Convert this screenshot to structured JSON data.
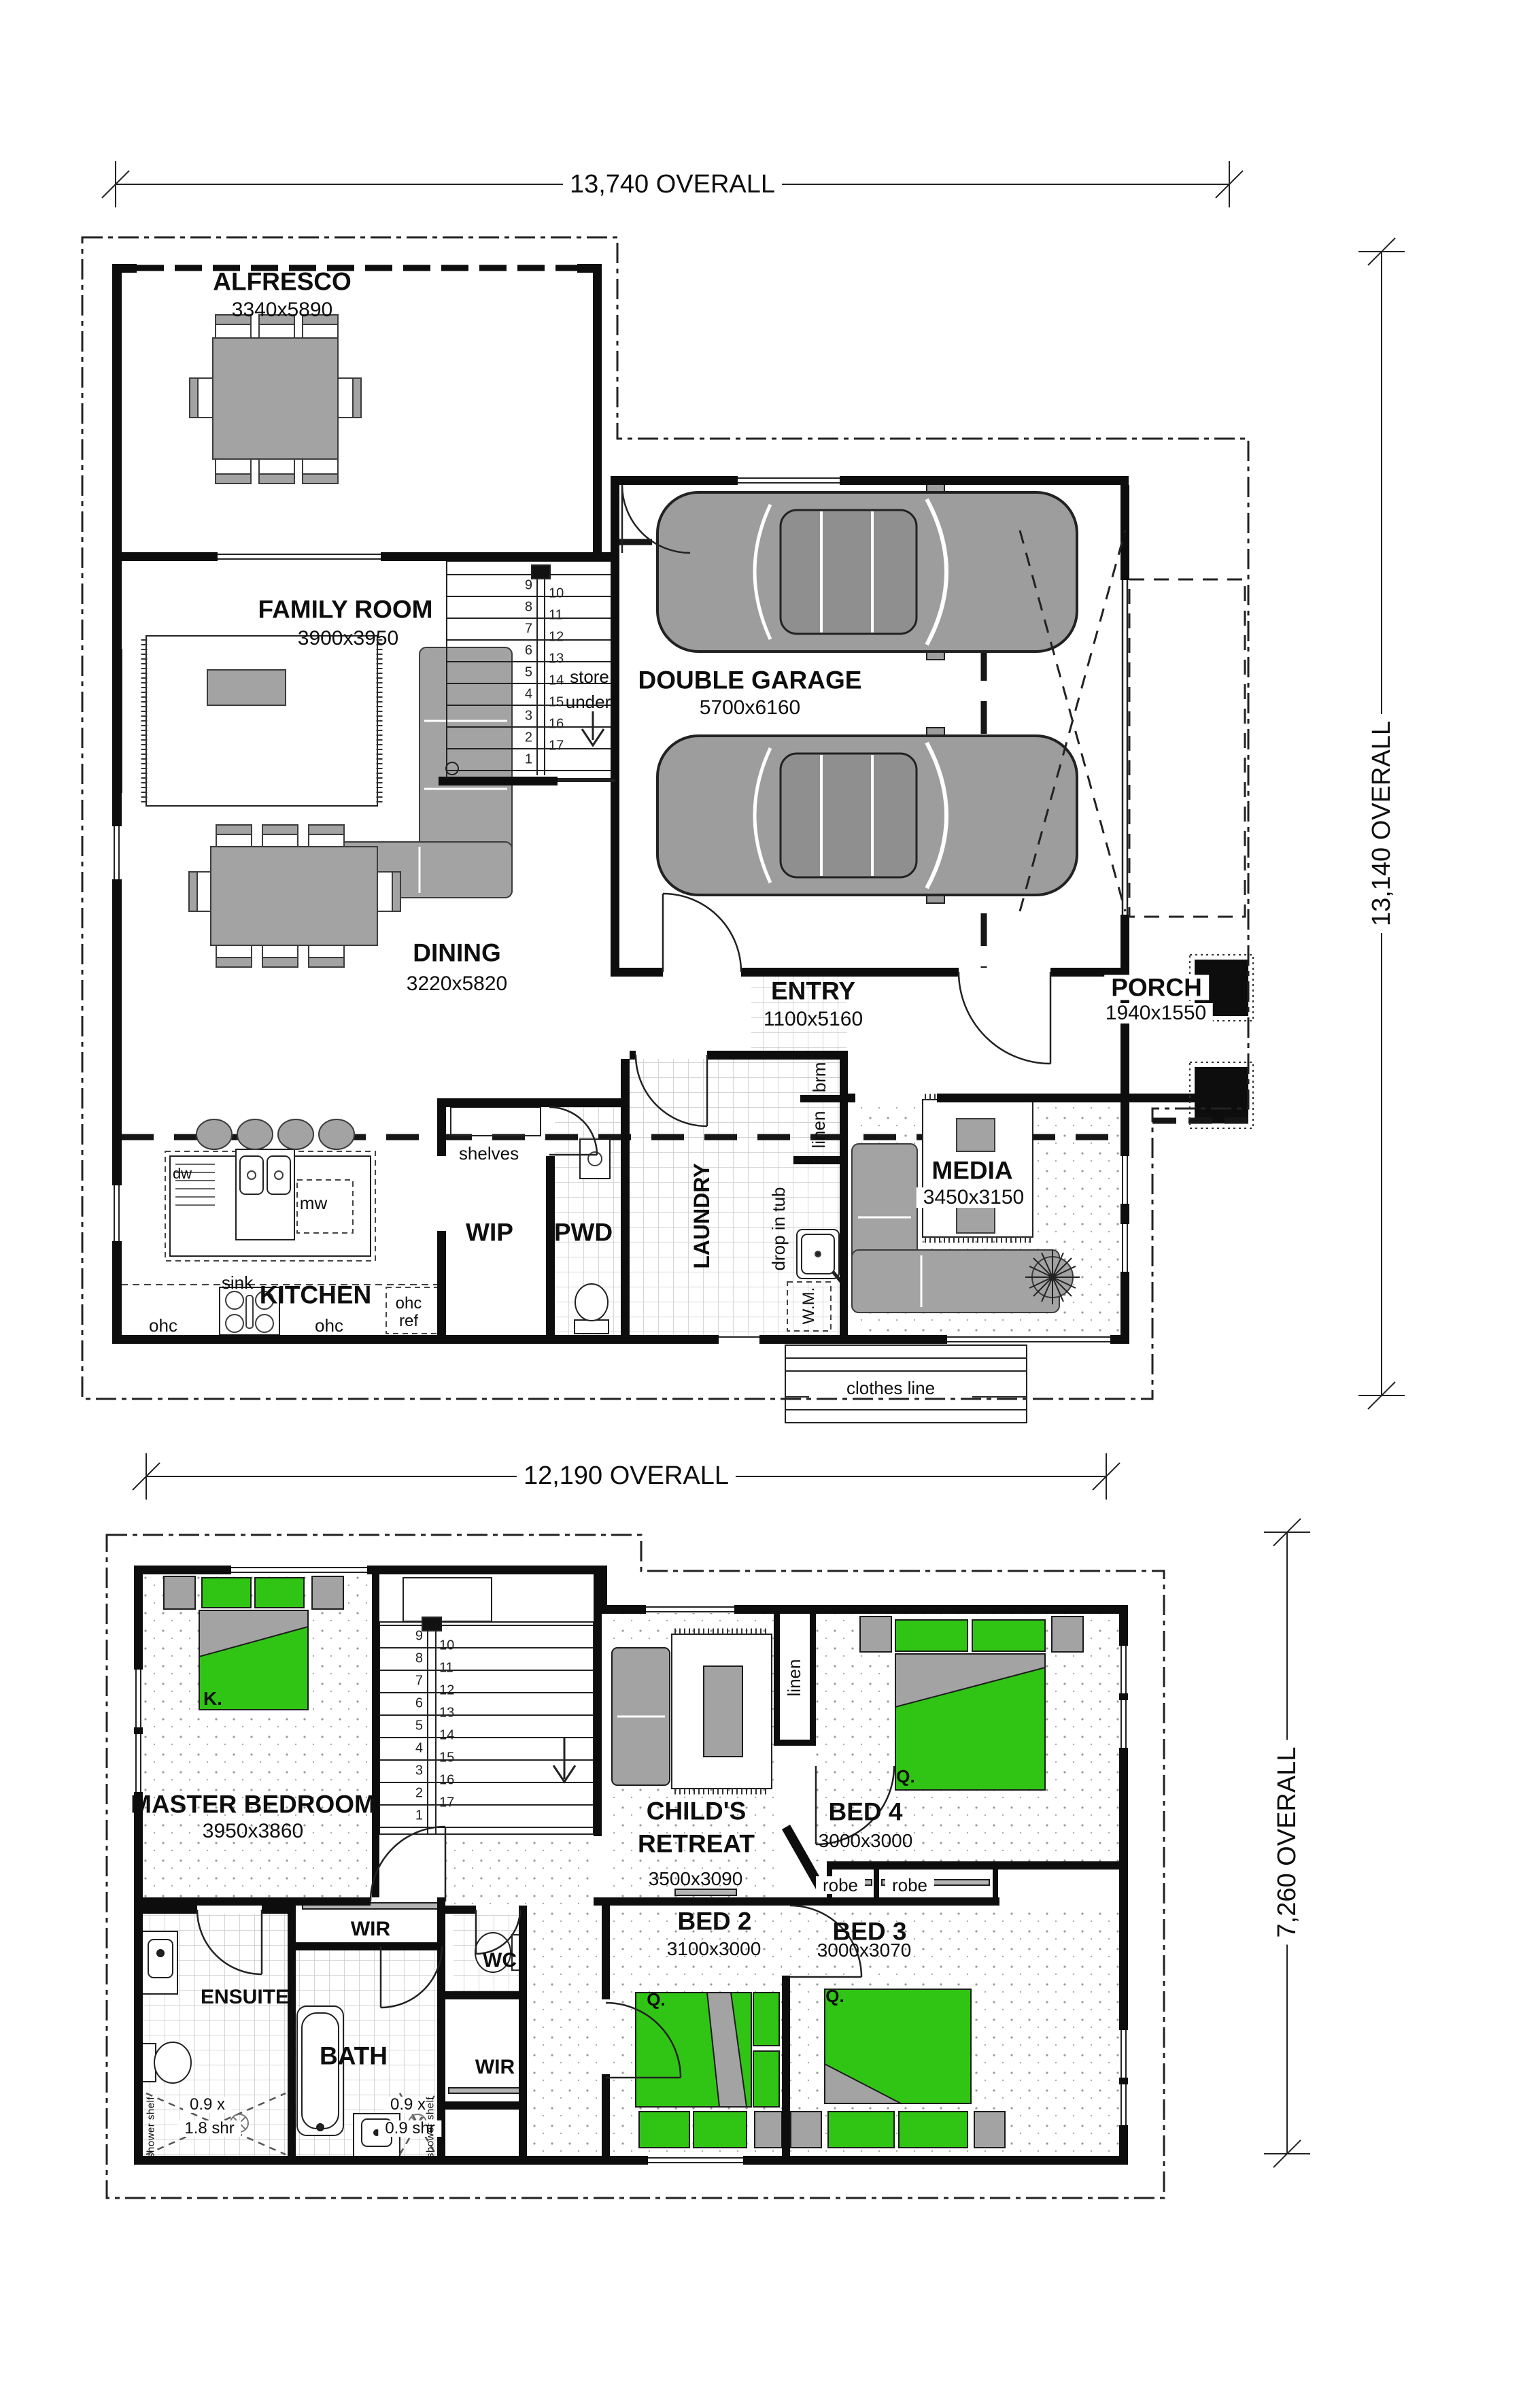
{
  "title": "Two storey house floor plan",
  "ground_floor": {
    "dimensions": {
      "width": "13,740 OVERALL",
      "height": "13,140 OVERALL"
    },
    "rooms": {
      "alfresco": {
        "name": "ALFRESCO",
        "size": "3340x5890"
      },
      "family_room": {
        "name": "FAMILY ROOM",
        "size": "3900x3950"
      },
      "double_garage": {
        "name": "DOUBLE GARAGE",
        "size": "5700x6160"
      },
      "dining": {
        "name": "DINING",
        "size": "3220x5820"
      },
      "entry": {
        "name": "ENTRY",
        "size": "1100x5160"
      },
      "porch": {
        "name": "PORCH",
        "size": "1940x1550"
      },
      "kitchen": {
        "name": "KITCHEN"
      },
      "wip": {
        "name": "WIP"
      },
      "pwd": {
        "name": "PWD"
      },
      "laundry": {
        "name": "LAUNDRY"
      },
      "media": {
        "name": "MEDIA",
        "size": "3450x3150"
      }
    },
    "labels": {
      "store": "store",
      "under": "under",
      "sink": "sink",
      "dw": "dw",
      "mw": "mw",
      "ohc_left": "ohc",
      "ohc_right": "ohc",
      "ohc_ref_top": "ohc",
      "ohc_ref_bottom": "ref",
      "shelves": "shelves",
      "brm": "brm",
      "linen": "linen",
      "drop_in_tub": "drop in tub",
      "wm": "W.M.",
      "clothes_line": "clothes line"
    },
    "stairs": {
      "left": [
        "9",
        "8",
        "7",
        "6",
        "5",
        "4",
        "3",
        "2",
        "1"
      ],
      "right": [
        "10",
        "11",
        "12",
        "13",
        "14",
        "15",
        "16",
        "17"
      ]
    }
  },
  "upper_floor": {
    "dimensions": {
      "width": "12,190 OVERALL",
      "height": "7,260 OVERALL"
    },
    "rooms": {
      "master": {
        "name": "MASTER BEDROOM",
        "size": "3950x3860"
      },
      "childs_retreat": {
        "name": "CHILD'S RETREAT",
        "name_line1": "CHILD'S",
        "name_line2": "RETREAT",
        "size": "3500x3090"
      },
      "bed4": {
        "name": "BED 4",
        "size": "3000x3000"
      },
      "bed2": {
        "name": "BED 2",
        "size": "3100x3000"
      },
      "bed3": {
        "name": "BED 3",
        "size": "3000x3070"
      },
      "wir_master": {
        "name": "WIR"
      },
      "wir_bed2": {
        "name": "WIR"
      },
      "ensuite": {
        "name": "ENSUITE"
      },
      "bath": {
        "name": "BATH"
      },
      "wc": {
        "name": "WC"
      }
    },
    "labels": {
      "linen": "linen",
      "robe_left": "robe",
      "robe_right": "robe",
      "bed_king": "K.",
      "bed_q4": "Q.",
      "bed_q2": "Q.",
      "bed_q3": "Q.",
      "ens_shower_1": "0.9 x",
      "ens_shower_2": "1.8 shr",
      "bath_shower_1": "0.9 x",
      "bath_shower_2": "0.9 shr",
      "shower_shelf_left": "shower shelf",
      "shower_shelf_right": "shower shelf"
    },
    "stairs": {
      "left": [
        "9",
        "8",
        "7",
        "6",
        "5",
        "4",
        "3",
        "2",
        "1"
      ],
      "right": [
        "10",
        "11",
        "12",
        "13",
        "14",
        "15",
        "16",
        "17"
      ]
    }
  },
  "colors": {
    "bed_green": "#30c514",
    "furniture_gray": "#a3a3a3",
    "wall_black": "#0d0d0d"
  }
}
